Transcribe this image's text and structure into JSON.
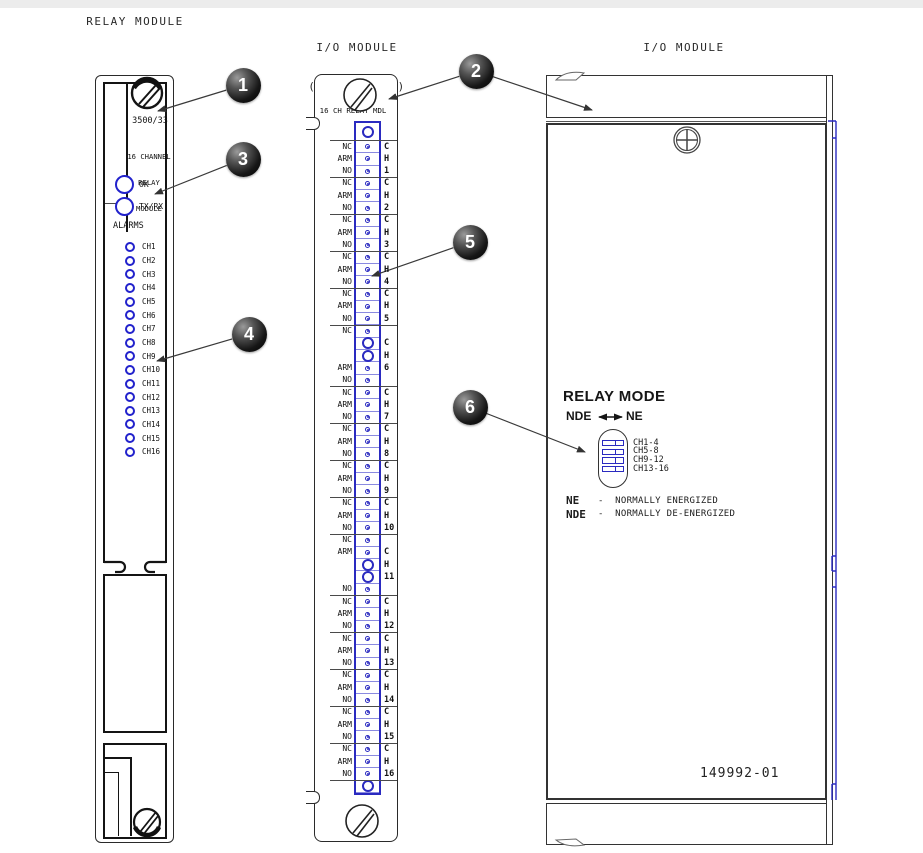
{
  "titles": {
    "left": "RELAY MODULE",
    "middle_line1": "I/O MODULE",
    "middle_line2": "(FRONT VIEW)",
    "right_line1": "I/O MODULE",
    "right_line2": "(LEFT SIDE VIEW)"
  },
  "colors": {
    "blue": "#2a2ac0",
    "line": "#3a3a3a"
  },
  "relay_module": {
    "model": "3500/33",
    "name_lines": [
      "16 CHANNEL",
      "RELAY",
      "MODULE"
    ],
    "status_leds": [
      {
        "label": "OK"
      },
      {
        "label": "TX/RX"
      }
    ],
    "alarms_label": "ALARMS",
    "alarm_channels": [
      "CH1",
      "CH2",
      "CH3",
      "CH4",
      "CH5",
      "CH6",
      "CH7",
      "CH8",
      "CH9",
      "CH10",
      "CH11",
      "CH12",
      "CH13",
      "CH14",
      "CH15",
      "CH16"
    ]
  },
  "io_front": {
    "header": "16 CH RELAY MDL",
    "rows": [
      {
        "ring": true
      },
      {
        "label": "NC"
      },
      {
        "label": "ARM"
      },
      {
        "label": "NO"
      },
      {
        "label": "NC"
      },
      {
        "label": "ARM"
      },
      {
        "label": "NO"
      },
      {
        "label": "NC"
      },
      {
        "label": "ARM"
      },
      {
        "label": "NO"
      },
      {
        "label": "NC"
      },
      {
        "label": "ARM"
      },
      {
        "label": "NO"
      },
      {
        "label": "NC"
      },
      {
        "label": "ARM"
      },
      {
        "label": "NO"
      },
      {
        "label": "NC"
      },
      {
        "ring": true
      },
      {
        "ring": true
      },
      {
        "label": "ARM"
      },
      {
        "label": "NO"
      },
      {
        "label": "NC"
      },
      {
        "label": "ARM"
      },
      {
        "label": "NO"
      },
      {
        "label": "NC"
      },
      {
        "label": "ARM"
      },
      {
        "label": "NO"
      },
      {
        "label": "NC"
      },
      {
        "label": "ARM"
      },
      {
        "label": "NO"
      },
      {
        "label": "NC"
      },
      {
        "label": "ARM"
      },
      {
        "label": "NO"
      },
      {
        "label": "NC"
      },
      {
        "label": "ARM"
      },
      {
        "ring": true
      },
      {
        "ring": true
      },
      {
        "label": "NO"
      },
      {
        "label": "NC"
      },
      {
        "label": "ARM"
      },
      {
        "label": "NO"
      },
      {
        "label": "NC"
      },
      {
        "label": "ARM"
      },
      {
        "label": "NO"
      },
      {
        "label": "NC"
      },
      {
        "label": "ARM"
      },
      {
        "label": "NO"
      },
      {
        "label": "NC"
      },
      {
        "label": "ARM"
      },
      {
        "label": "NO"
      },
      {
        "label": "NC"
      },
      {
        "label": "ARM"
      },
      {
        "label": "NO"
      },
      {
        "ring": true
      }
    ],
    "separators_after": [
      0,
      3,
      6,
      9,
      12,
      15,
      20,
      23,
      26,
      29,
      32,
      37,
      40,
      43,
      46,
      49,
      52
    ],
    "channel_labels": [
      {
        "ch": "1",
        "rows": [
          1,
          2,
          3
        ]
      },
      {
        "ch": "2",
        "rows": [
          4,
          5,
          6
        ]
      },
      {
        "ch": "3",
        "rows": [
          7,
          8,
          9
        ]
      },
      {
        "ch": "4",
        "rows": [
          10,
          11,
          12
        ]
      },
      {
        "ch": "5",
        "rows": [
          13,
          14,
          15
        ]
      },
      {
        "ch": "6",
        "rows": [
          17,
          18,
          19
        ]
      },
      {
        "ch": "7",
        "rows": [
          21,
          22,
          23
        ]
      },
      {
        "ch": "8",
        "rows": [
          24,
          25,
          26
        ]
      },
      {
        "ch": "9",
        "rows": [
          27,
          28,
          29
        ]
      },
      {
        "ch": "10",
        "rows": [
          30,
          31,
          32
        ]
      },
      {
        "ch": "11",
        "rows": [
          34,
          35,
          36
        ]
      },
      {
        "ch": "12",
        "rows": [
          38,
          39,
          40
        ]
      },
      {
        "ch": "13",
        "rows": [
          41,
          42,
          43
        ]
      },
      {
        "ch": "14",
        "rows": [
          44,
          45,
          46
        ]
      },
      {
        "ch": "15",
        "rows": [
          47,
          48,
          49
        ]
      },
      {
        "ch": "16",
        "rows": [
          50,
          51,
          52
        ]
      }
    ],
    "letters": [
      "C",
      "H"
    ]
  },
  "io_side": {
    "relay_mode_title": "RELAY MODE",
    "nde_label": "NDE",
    "ne_label": "NE",
    "dip_groups": [
      "CH1-4",
      "CH5-8",
      "CH9-12",
      "CH13-16"
    ],
    "legend": [
      {
        "term": "NE",
        "desc": "-  NORMALLY ENERGIZED"
      },
      {
        "term": "NDE",
        "desc": "-  NORMALLY DE-ENERGIZED"
      }
    ],
    "part_number": "149992-01"
  },
  "callouts": [
    {
      "num": "1"
    },
    {
      "num": "2"
    },
    {
      "num": "3"
    },
    {
      "num": "4"
    },
    {
      "num": "5"
    },
    {
      "num": "6"
    }
  ]
}
